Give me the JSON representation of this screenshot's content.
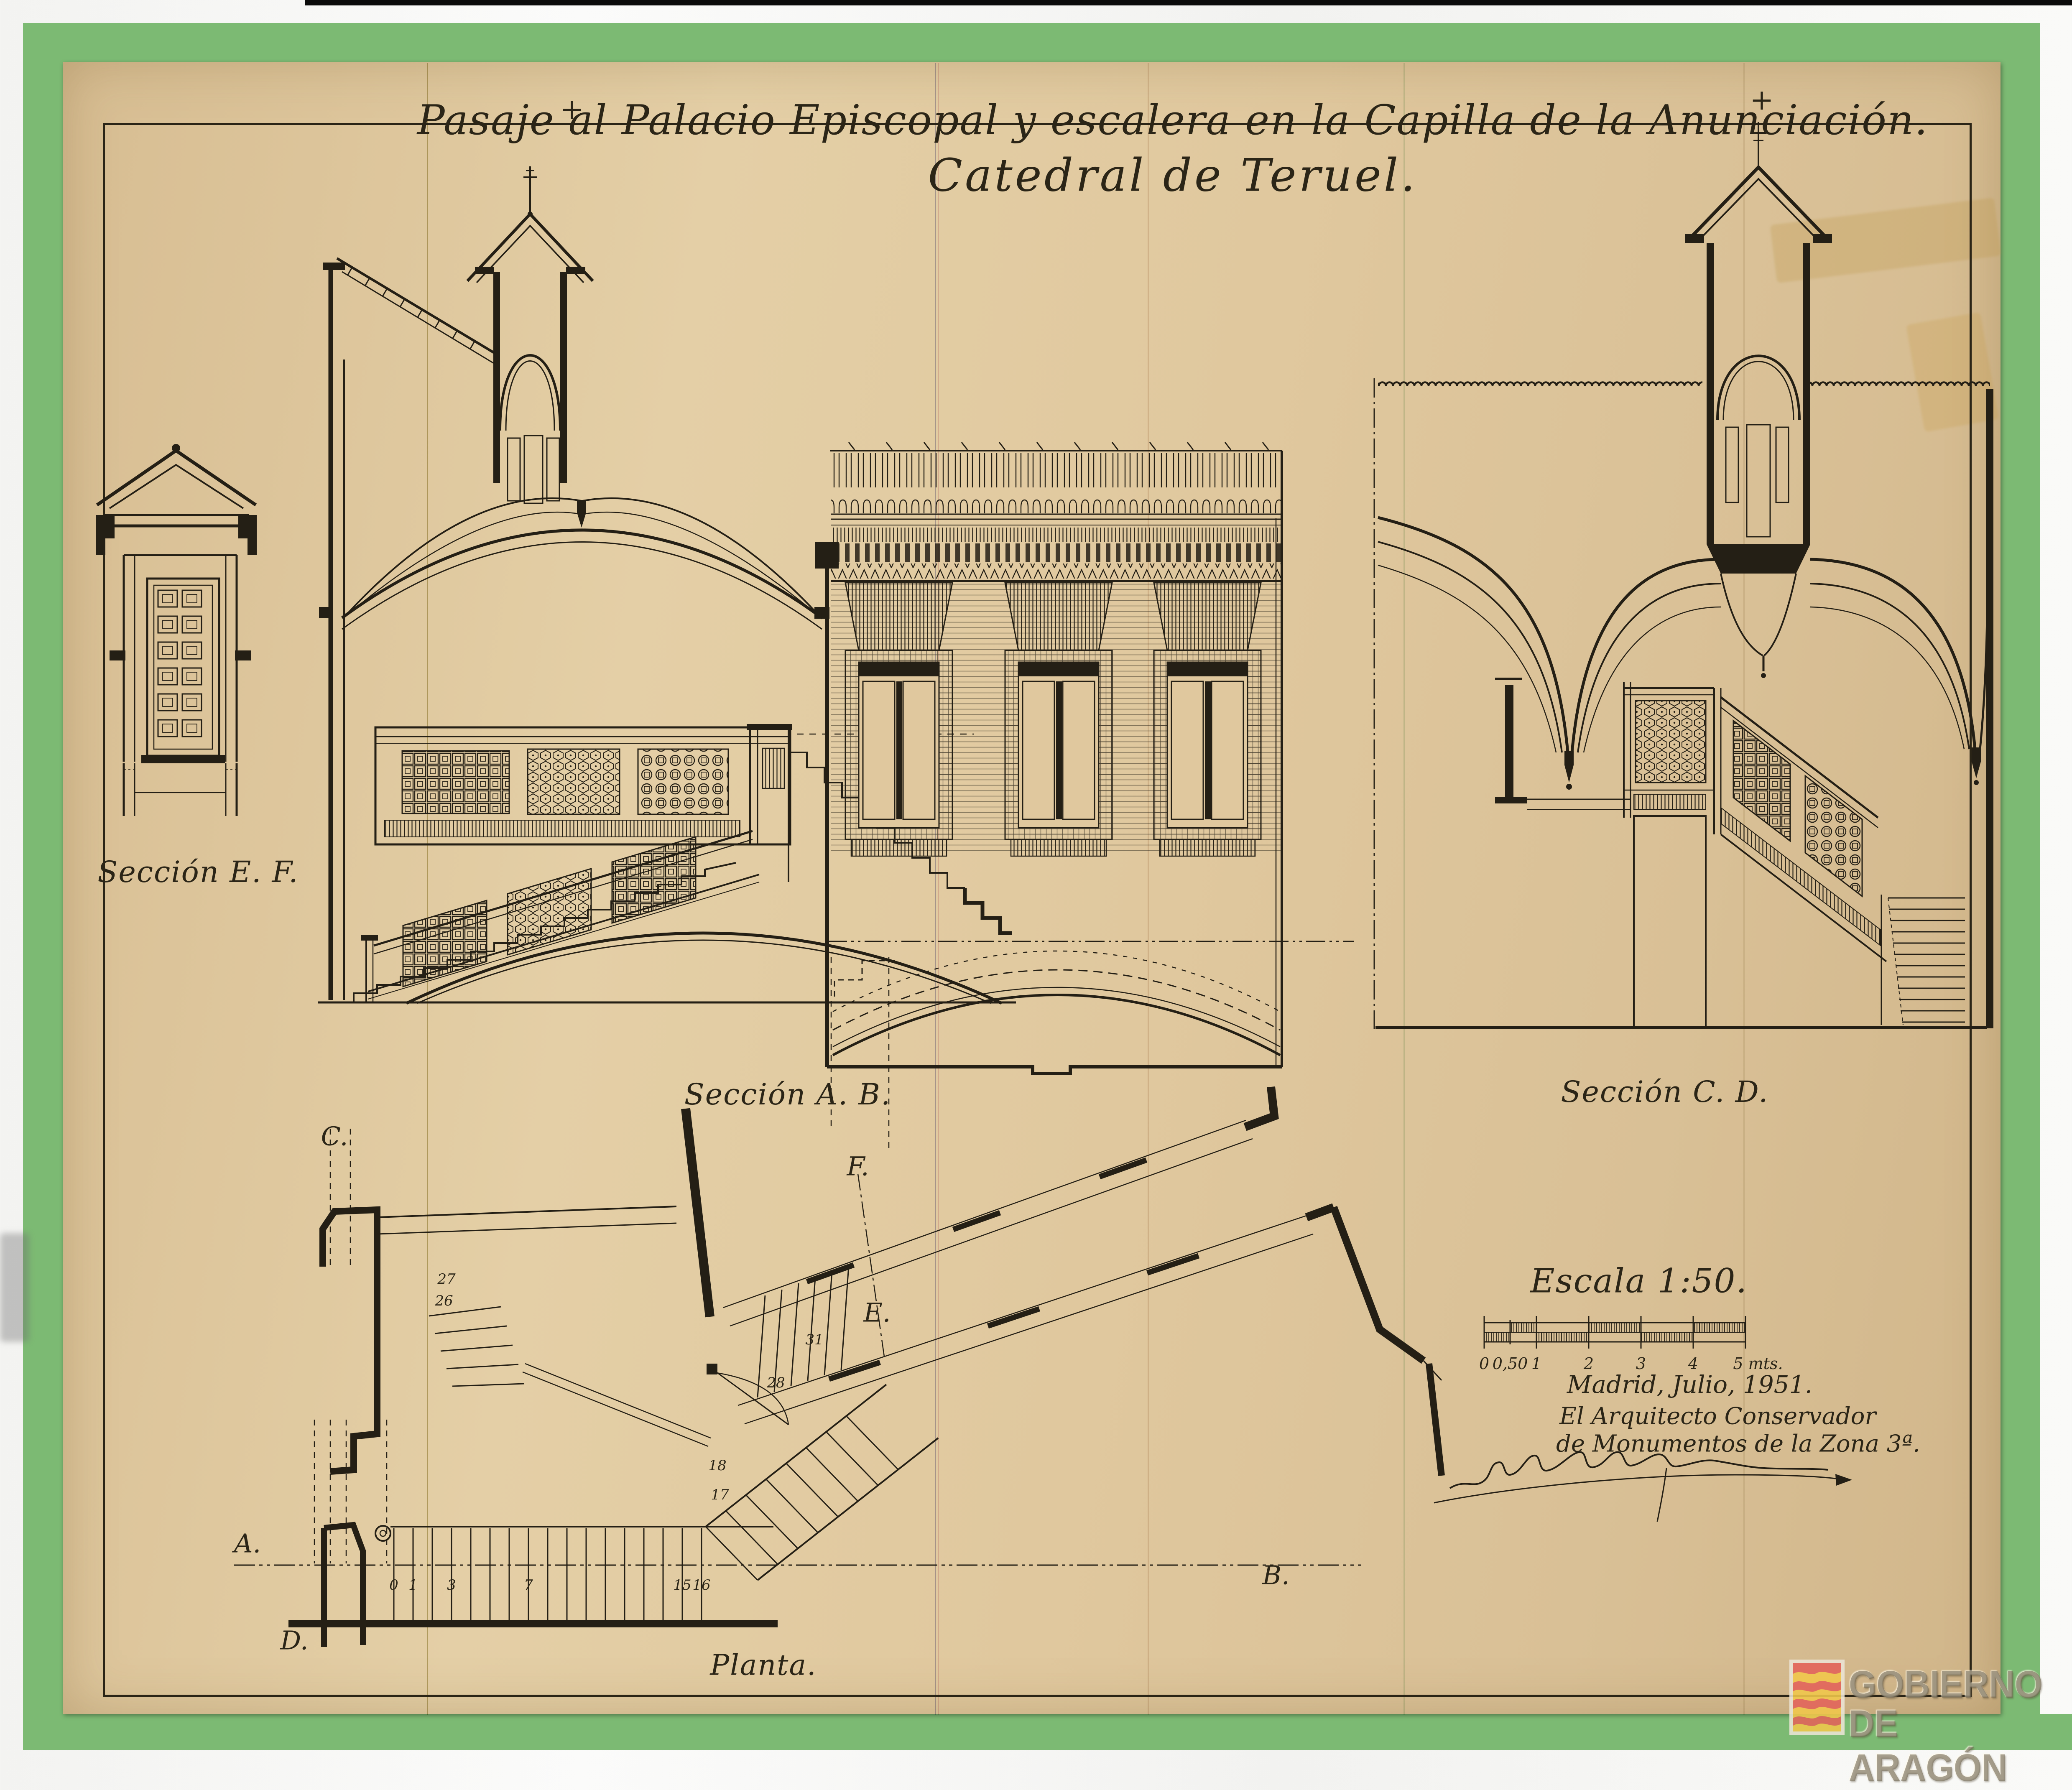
{
  "page": {
    "background_color": "#f6f6f4",
    "paper_color": "#ddc69e",
    "green_border_color": "#7cba73",
    "ink_color": "#2a2416"
  },
  "title": {
    "line1": "Pasaje al Palacio Episcopal y escalera en la Capilla de la Anunciación.",
    "line2": "Catedral de Teruel.",
    "cross_mark": "+"
  },
  "sections": {
    "ef": {
      "label": "Sección E. F."
    },
    "ab": {
      "label": "Sección A. B."
    },
    "cd": {
      "label": "Sección C. D."
    },
    "planta": {
      "label": "Planta."
    }
  },
  "plan": {
    "labels": {
      "a": "A.",
      "b": "B.",
      "c": "C.",
      "d": "D.",
      "e": "E.",
      "f": "F."
    },
    "step_numbers": [
      "0",
      "1",
      "3",
      "7",
      "15",
      "16",
      "17",
      "18",
      "26",
      "27",
      "28",
      "31"
    ]
  },
  "scale_block": {
    "label": "Escala 1:50.",
    "tick_labels": [
      "0",
      "0,50",
      "1",
      "2",
      "3",
      "4",
      "5 mts."
    ]
  },
  "attribution": {
    "line1": "Madrid, Julio, 1951.",
    "line2": "El Arquitecto Conservador",
    "line3": "de Monumentos de la Zona 3ª.",
    "signature_name": "Manuel Lorente Junquera"
  },
  "watermark": {
    "line1": "GOBIERNO",
    "line2": "DE ARAGÓN"
  }
}
